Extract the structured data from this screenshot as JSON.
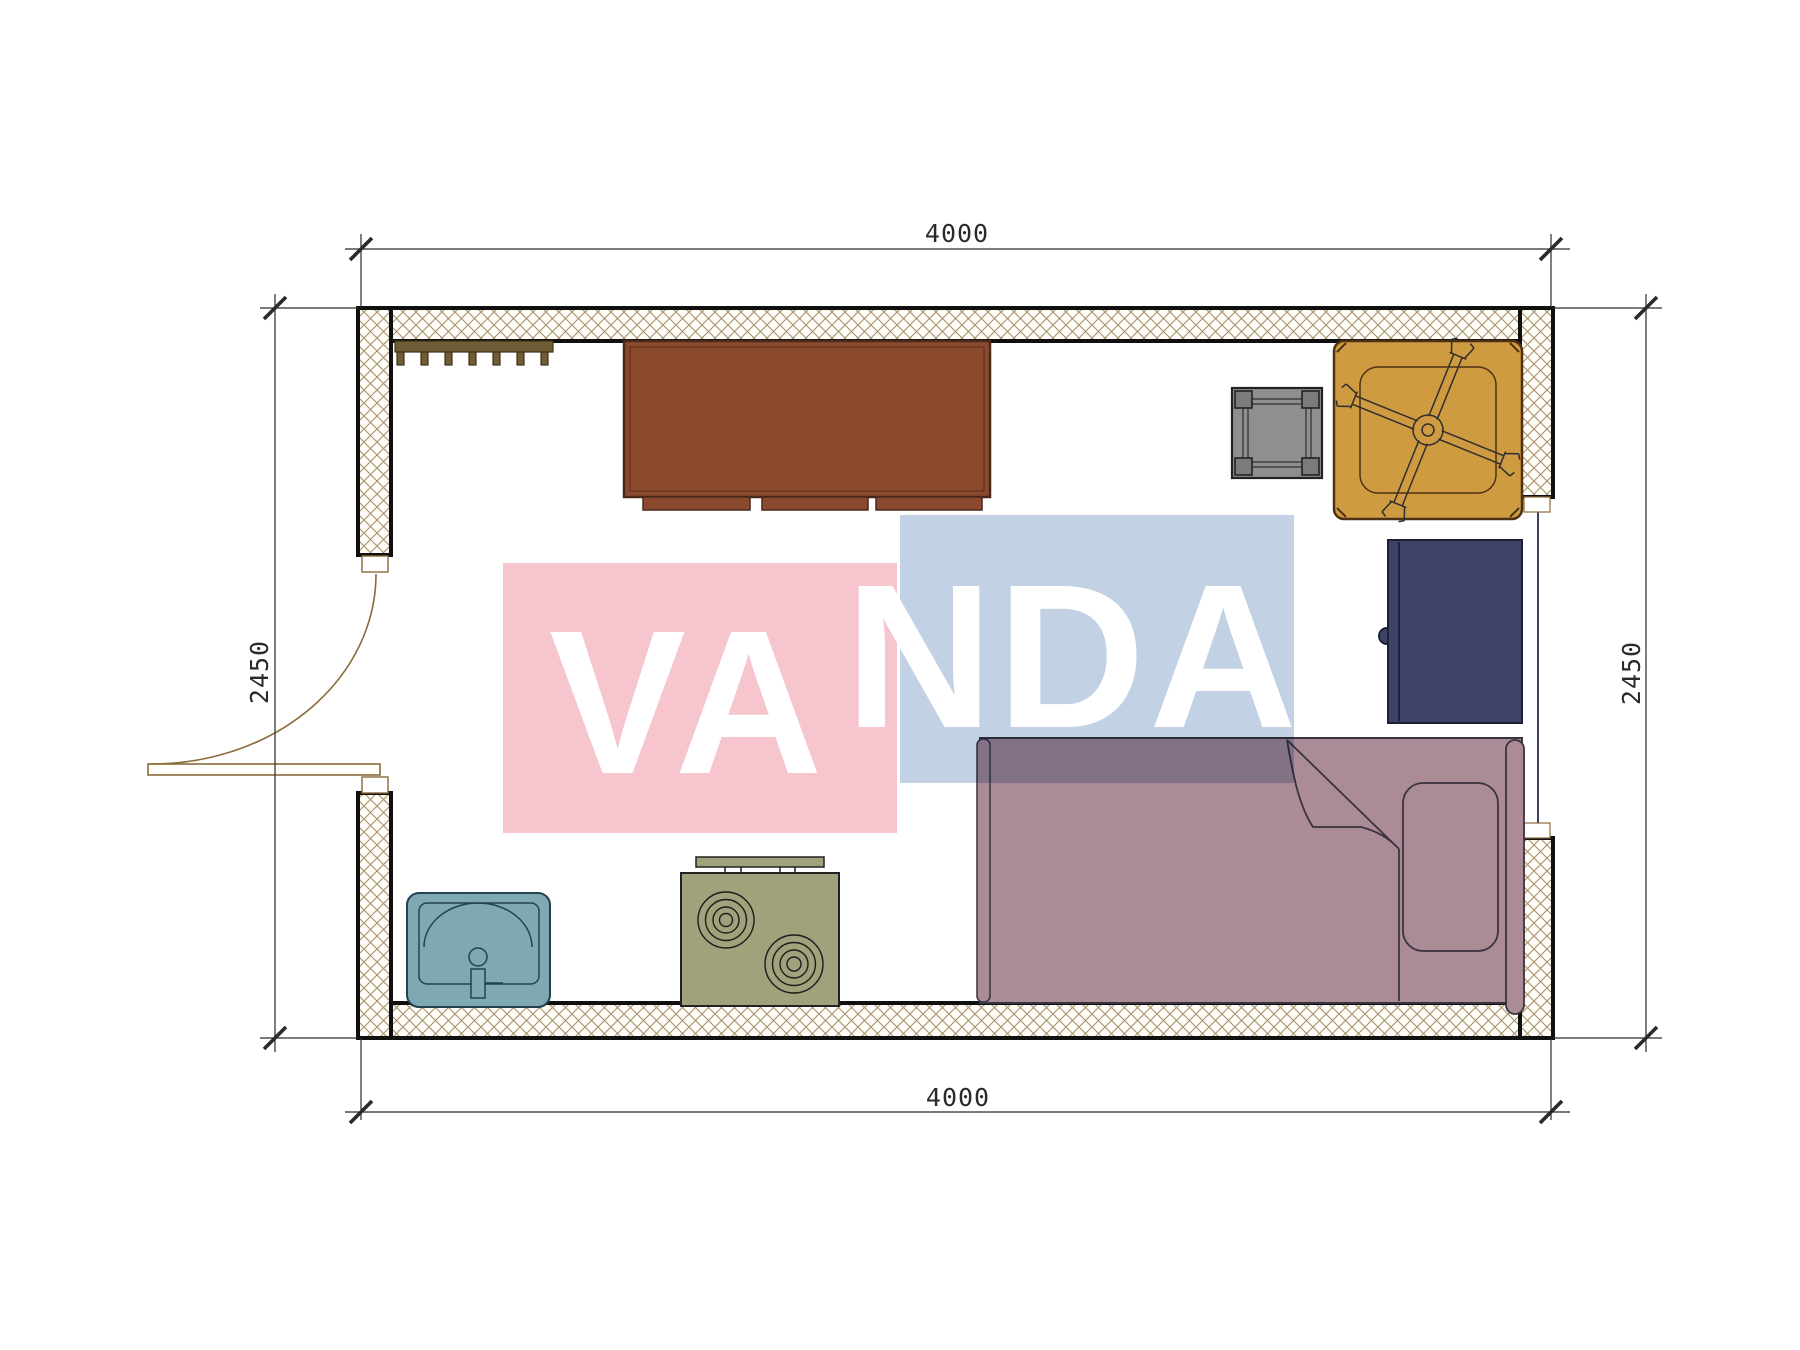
{
  "plan": {
    "type": "floor-plan",
    "dimensions": {
      "top": "4000",
      "bottom": "4000",
      "left": "2450",
      "right": "2450"
    },
    "watermark": {
      "text": "VANDA",
      "segment_left": "VA",
      "segment_right": "NDA"
    },
    "colors": {
      "wall_hatch_line": "#a5906a",
      "wall_fill": "#fffdf7",
      "wall_outline": "#101010",
      "desk": "#8b4a2d",
      "desk_outline": "#4a281a",
      "coat_rack": "#6f5d35",
      "stool": "#8f8f8f",
      "stool_leg": "#7b7b7b",
      "table": "#cf9b40",
      "table_outline": "#4d3114",
      "cabinet": "#3d4266",
      "cabinet_outline": "#1d2136",
      "bed": "#ab8b96",
      "bed_outline": "#3a3340",
      "sink": "#7fa8b5",
      "sink_outline": "#24424e",
      "stove": "#a1a17b",
      "stove_outline": "#222222",
      "door": "#8a6a3a",
      "window_glass": "#3a4166",
      "dimension_line": "#2a2a2a",
      "watermark_pink": "#f6c5ce",
      "watermark_blue": "#c2d1e4",
      "watermark_text": "#ffffff"
    },
    "furniture": [
      "coat-rack",
      "desk",
      "stool",
      "pedestal-table",
      "cabinet",
      "single-bed-with-pillow-and-blanket",
      "sink",
      "two-burner-stove"
    ],
    "openings": [
      "entry-door-left-wall",
      "window-right-wall"
    ]
  }
}
